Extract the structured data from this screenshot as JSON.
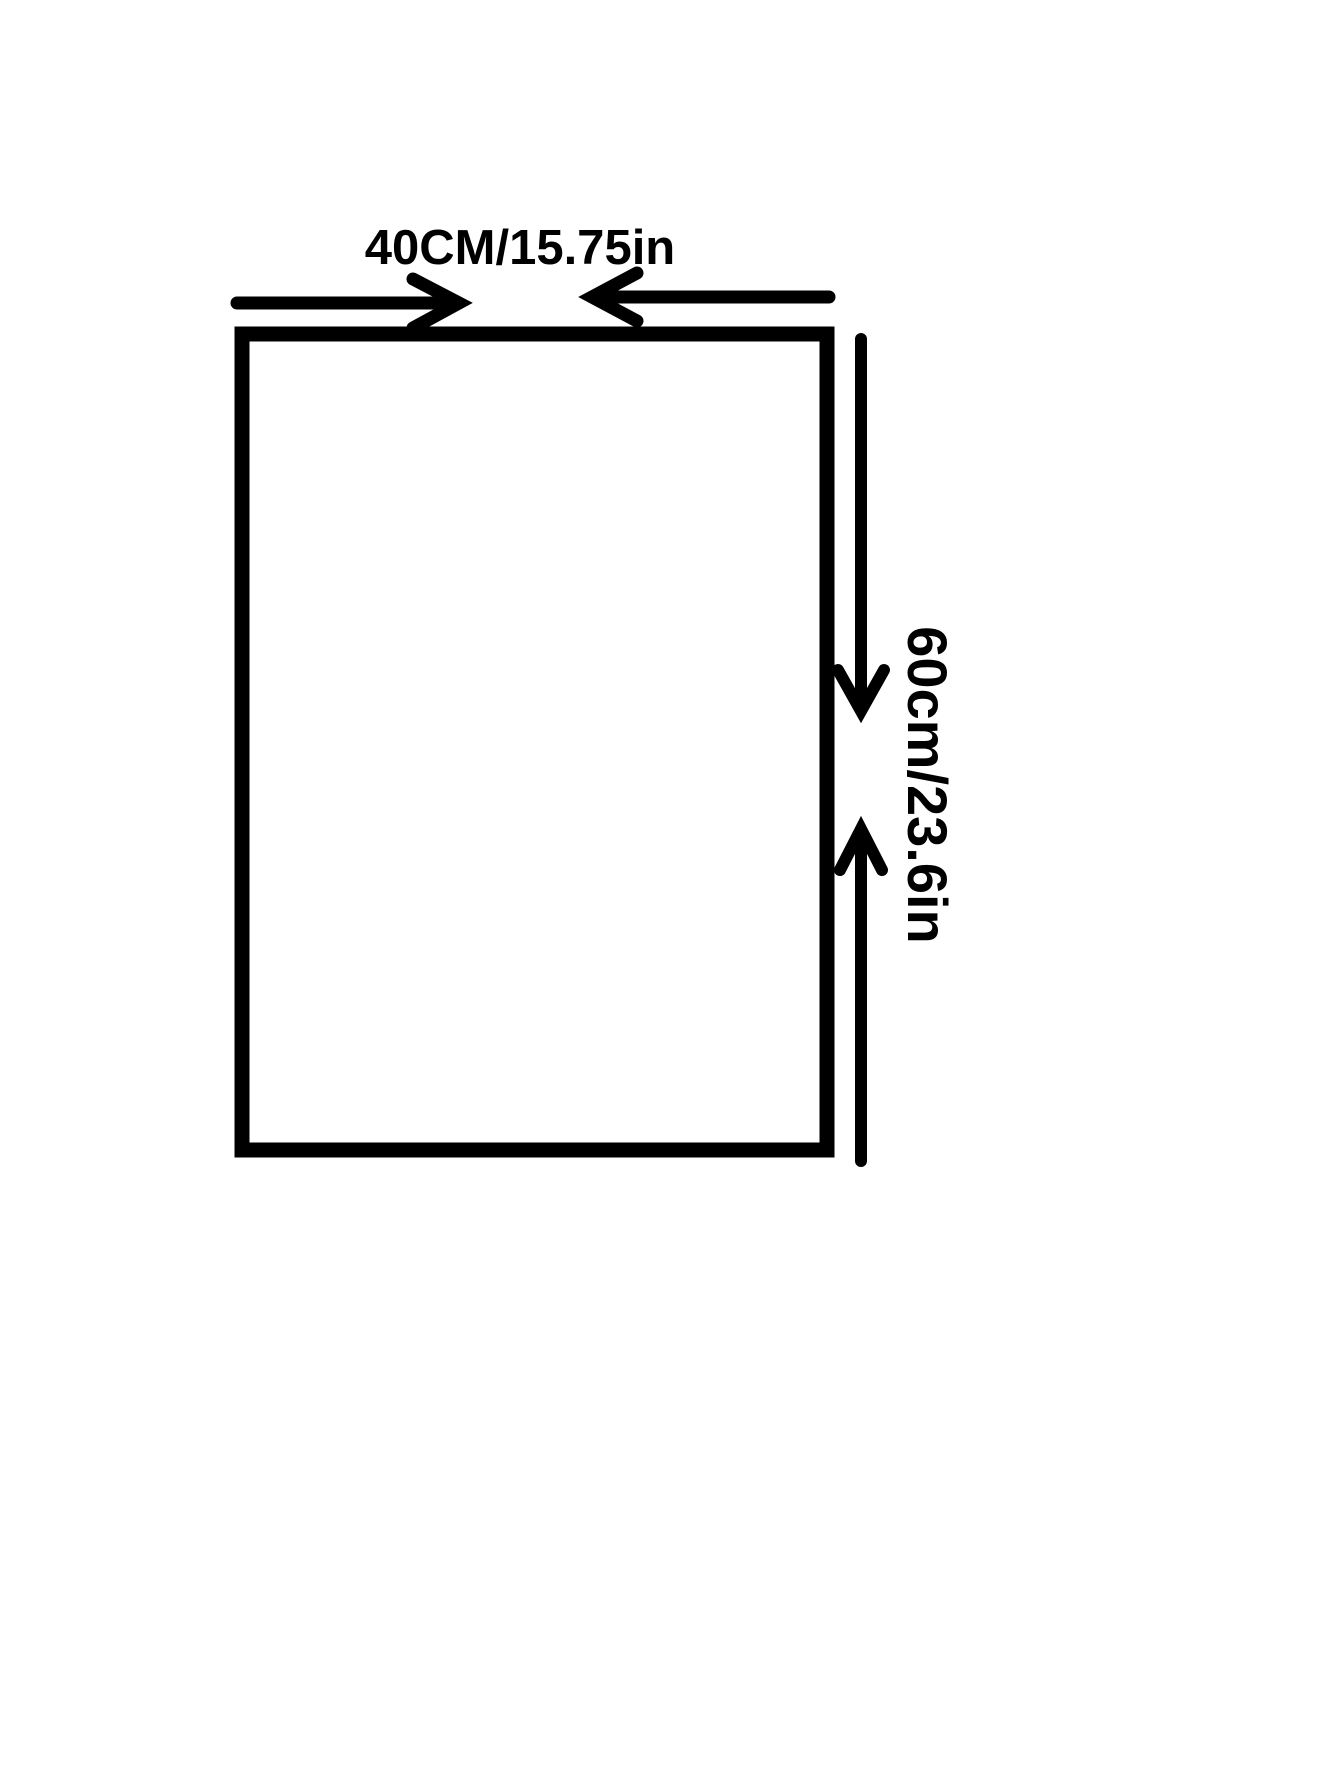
{
  "diagram": {
    "width_label": "40CM/15.75in",
    "height_label": "60cm/23.6in",
    "colors": {
      "ink": "#000000",
      "background": "#ffffff"
    }
  }
}
